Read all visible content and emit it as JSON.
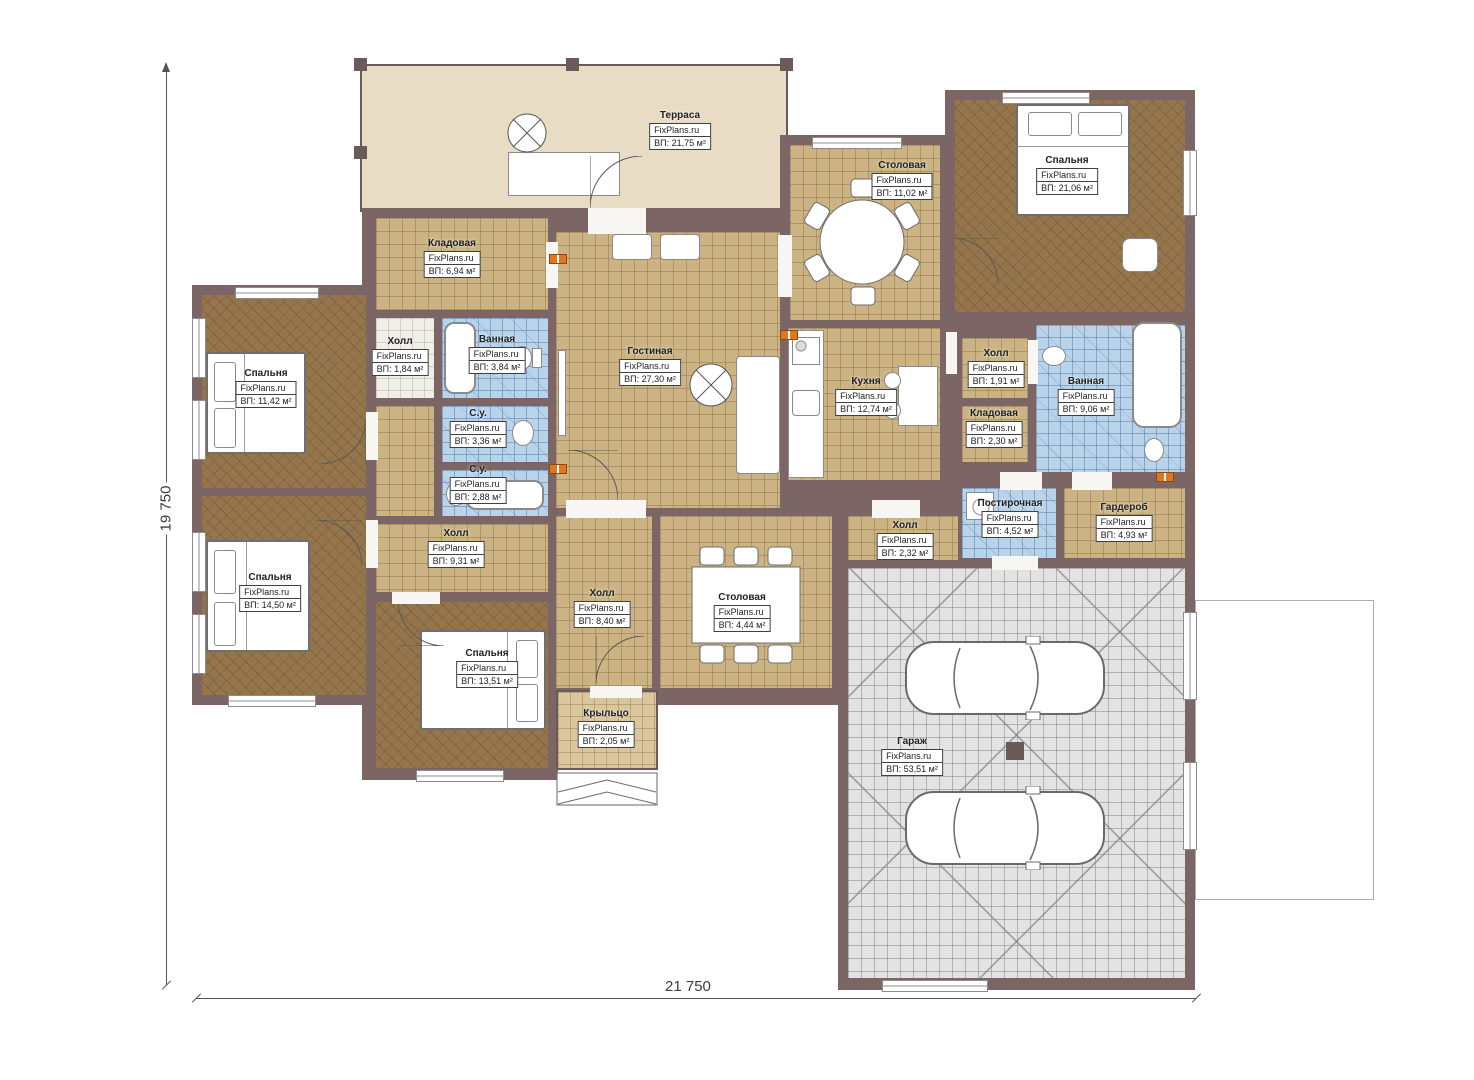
{
  "brand": "FixPlans.ru",
  "dimensions": {
    "bottom": "21 750",
    "left": "19 750"
  },
  "rooms": [
    {
      "name": "Терраса",
      "area": "ВП: 21,75 м²"
    },
    {
      "name": "Столовая",
      "area": "ВП: 11,02 м²"
    },
    {
      "name": "Спальня",
      "area": "ВП: 21,06 м²"
    },
    {
      "name": "Кладовая",
      "area": "ВП: 6,94 м²"
    },
    {
      "name": "Холл",
      "area": "ВП: 1,84 м²"
    },
    {
      "name": "Ванная",
      "area": "ВП: 3,84 м²"
    },
    {
      "name": "С.у.",
      "area": "ВП: 3,36 м²"
    },
    {
      "name": "С.у.",
      "area": "ВП: 2,88 м²"
    },
    {
      "name": "Гостиная",
      "area": "ВП: 27,30 м²"
    },
    {
      "name": "Кухня",
      "area": "ВП: 12,74 м²"
    },
    {
      "name": "Холл",
      "area": "ВП: 1,91 м²"
    },
    {
      "name": "Кладовая",
      "area": "ВП: 2,30 м²"
    },
    {
      "name": "Ванная",
      "area": "ВП: 9,06 м²"
    },
    {
      "name": "Спальня",
      "area": "ВП: 11,42 м²"
    },
    {
      "name": "Спальня",
      "area": "ВП: 14,50 м²"
    },
    {
      "name": "Холл",
      "area": "ВП: 9,31 м²"
    },
    {
      "name": "Спальня",
      "area": "ВП: 13,51 м²"
    },
    {
      "name": "Холл",
      "area": "ВП: 8,40 м²"
    },
    {
      "name": "Столовая",
      "area": "ВП: 4,44 м²"
    },
    {
      "name": "Холл",
      "area": "ВП: 2,32 м²"
    },
    {
      "name": "Постирочная",
      "area": "ВП: 4,52 м²"
    },
    {
      "name": "Гардероб",
      "area": "ВП: 4,93 м²"
    },
    {
      "name": "Крыльцо",
      "area": "ВП: 2,05 м²"
    },
    {
      "name": "Гараж",
      "area": "ВП: 53,51 м²"
    }
  ]
}
